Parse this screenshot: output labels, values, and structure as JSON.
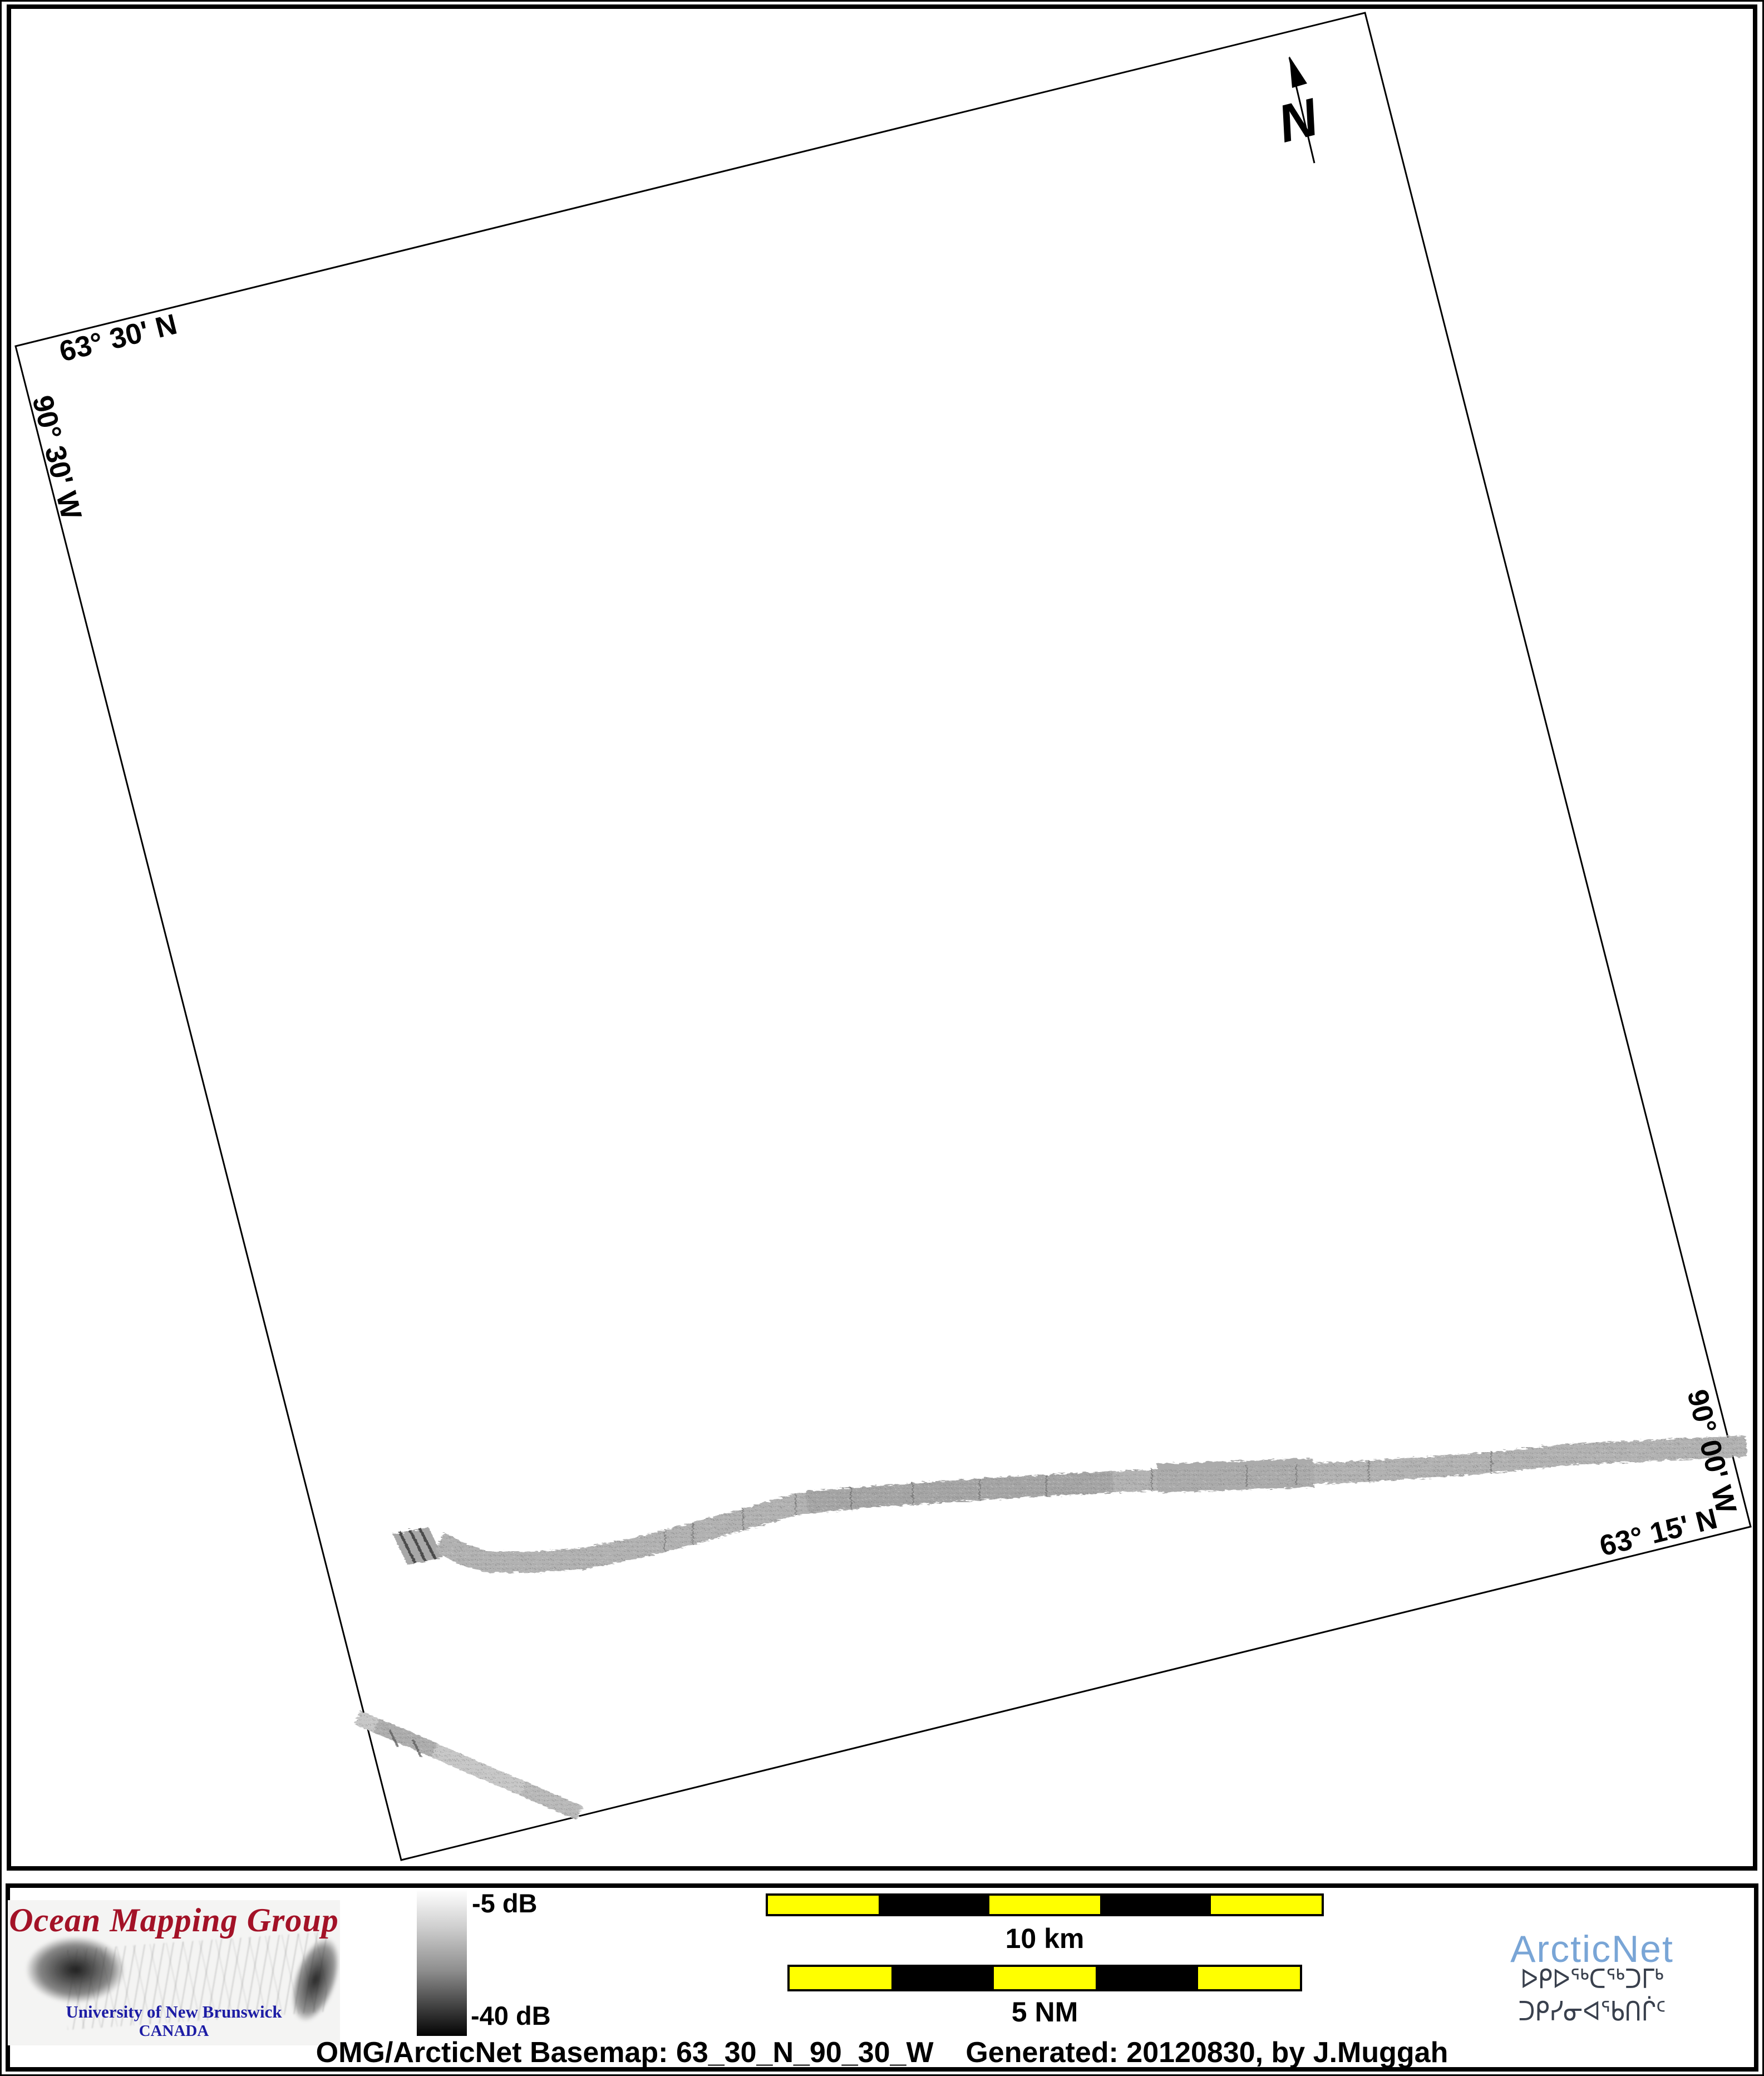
{
  "map": {
    "graticule_labels": {
      "top_latitude": "63° 30' N",
      "west_longitude": "90° 30' W",
      "east_longitude": "90° 00' W",
      "bottom_latitude": "63° 15' N"
    },
    "north_arrow_label": "N",
    "features": {
      "survey_tracks": "grayscale multibeam backscatter swaths",
      "track_gray": "#b2b2b2"
    }
  },
  "footer": {
    "omg_logo": {
      "title": "Ocean Mapping Group",
      "institution": "University of New Brunswick",
      "country": "CANADA",
      "title_color": "#a31227",
      "text_color": "#1d1da5"
    },
    "colorbar": {
      "max_label": "-5 dB",
      "min_label": "-40 dB",
      "top_color": "#fdfdfd",
      "bottom_color": "#000000"
    },
    "scalebars": {
      "km": {
        "label": "10 km",
        "segment_colors": [
          "#ffff00",
          "#000000",
          "#ffff00",
          "#000000",
          "#ffff00"
        ]
      },
      "nm": {
        "label": "5 NM",
        "segment_colors": [
          "#ffff00",
          "#000000",
          "#ffff00",
          "#000000",
          "#ffff00"
        ]
      }
    },
    "arcticnet_logo": {
      "name": "ArcticNet",
      "inuktitut": "ᐅᑭᐅᖅᑕᖅᑐᒥᒃ ᑐᑭᓯᓂᐊᖃᑎᒌᑦ",
      "name_color": "#79a5d6",
      "inuktitut_color": "#39404d"
    },
    "caption": "OMG/ArcticNet Basemap: 63_30_N_90_30_W    Generated: 20120830, by J.Muggah"
  }
}
